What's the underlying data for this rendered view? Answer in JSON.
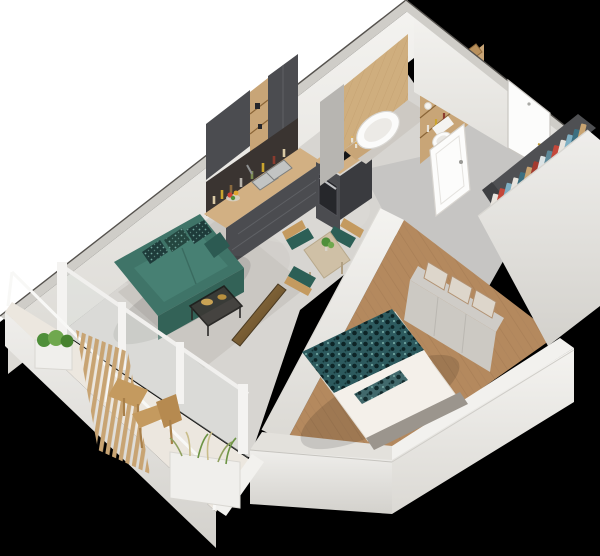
{
  "scene": {
    "title": "3D isometric cutaway floor plan of a one-bedroom apartment on a black background",
    "rooms": [
      {
        "name": "living-room",
        "contents": [
          "teal fabric sofa with patterned cushions",
          "black-frame coffee table with gold trays",
          "wall-mounted TV seen from behind",
          "light grey area rug",
          "floor-to-ceiling balcony windows"
        ]
      },
      {
        "name": "dining-area",
        "contents": [
          "beige dining table with potted plant",
          "three wooden chairs with teal seat cushions"
        ]
      },
      {
        "name": "kitchen",
        "contents": [
          "dark grey upper cabinets",
          "open oak shelving",
          "dark backsplash with bottles and jars",
          "oak countertop with double sink and fruit bowl",
          "dark grey base drawers",
          "oven unit with black cooktop"
        ]
      },
      {
        "name": "bathroom",
        "contents": [
          "oak panelled wall",
          "freestanding white oval bathtub",
          "candles",
          "oak shelf unit with wicker baskets, rolled towels and bottles",
          "wall-hung toilet",
          "white bathroom door"
        ]
      },
      {
        "name": "hallway",
        "contents": [
          "white entrance door with gold handle and peephole",
          "open wardrobe with colourful hanging clothes",
          "grey tiled floor"
        ]
      },
      {
        "name": "bedroom",
        "contents": [
          "double bed with teal patterned duvet and white sheets",
          "grey upholstered headboard",
          "stepped storage unit with beige boxes",
          "oak plank flooring"
        ]
      },
      {
        "name": "balcony",
        "contents": [
          "white parapet with glass balustrade",
          "vertical wood-slat privacy screen",
          "planter box with green shrubs",
          "planter box with ornamental grasses",
          "small wooden bistro table",
          "wooden chair"
        ]
      }
    ],
    "wardrobe": {
      "clothes_colors": [
        "#e8e4de",
        "#c4473a",
        "#7fb0c4",
        "#e8e4de",
        "#3c6f80",
        "#c9a471",
        "#a33b2f",
        "#dce4e6",
        "#5e8a9a",
        "#c4473a",
        "#e8e4de",
        "#7fb0c4",
        "#3c6f80",
        "#c9a471"
      ]
    },
    "colors": {
      "background": "#000000",
      "backdrop": "#ffffff",
      "wall_light": "#f2f1ee",
      "wall_mid": "#e3e1dc",
      "wall_shadow": "#cfcdc8",
      "wall_edge": "#55524e",
      "floor_concrete": "#d7d5d1",
      "rug": "#c9c6c1",
      "floor_tile": "#c6c5c3",
      "floor_wood": "#b4895e",
      "balcony_floor": "#ece7df",
      "wood_light": "#d2b083",
      "wood_mid": "#c8a577",
      "wood_dark": "#8a6537",
      "wood_wall": "#cfae7e",
      "cabinet_dark": "#4b4c50",
      "cabinet_darker": "#3a3b3f",
      "backsplash": "#3a3431",
      "appliance_black": "#141517",
      "steel": "#c0c1c4",
      "sofa": "#3f7468",
      "sofa_dark": "#336257",
      "sofa_light": "#478073",
      "pillow_dark": "#1e3b3a",
      "duvet": "#2d5a5e",
      "duvet_spot": "#0d2426",
      "sheet": "#f4f0ea",
      "headboard": "#9b958d",
      "storage_grey": "#cfccc7",
      "box_beige": "#ddd6cb",
      "tv_bronze": "#8a6a3e",
      "gold": "#c9a355",
      "plant_green": "#4f8f3a",
      "plant_light": "#6fa84e",
      "grass": "#c9bd8a",
      "door_white": "#fcfcfb",
      "handle_gold": "#c09a35",
      "tub_white": "#fbfbfa",
      "porcelain_shadow": "#eceae6",
      "table_beige": "#cfc0a6",
      "chair_wood": "#c49a5f",
      "seat_teal": "#2c5f56",
      "basket": "#b9905c",
      "glass": "#dfe4e2"
    }
  }
}
